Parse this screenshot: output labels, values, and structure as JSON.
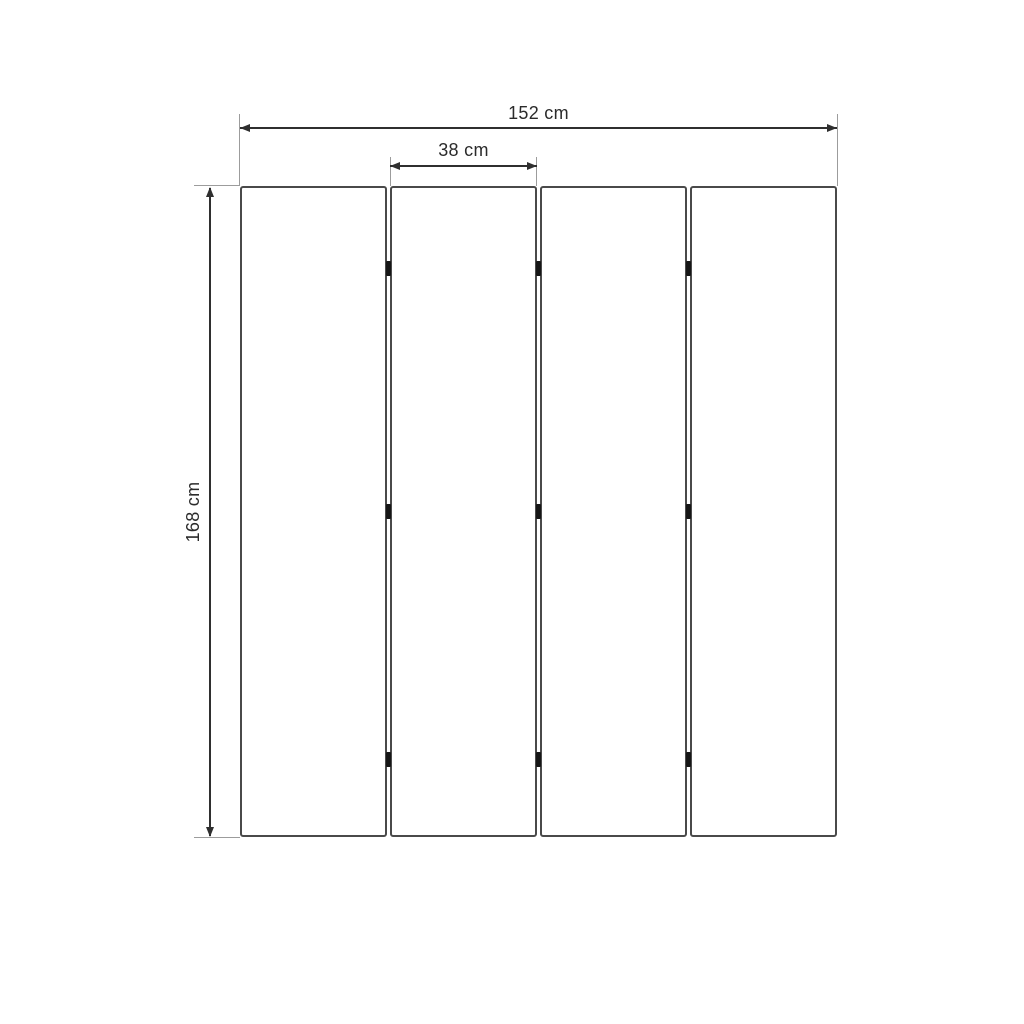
{
  "drawing": {
    "type": "folding-screen-dimension-diagram",
    "panel_count": 4,
    "labels": {
      "total_width": "152 cm",
      "panel_width": "38 cm",
      "height": "168 cm"
    },
    "colors": {
      "dimension_line": "#2f2f2f",
      "extension_line": "#9c9c9c",
      "panel_border": "#4a4a4a",
      "hinge": "#161616",
      "text": "#2b2b2b",
      "background": "#ffffff"
    }
  }
}
